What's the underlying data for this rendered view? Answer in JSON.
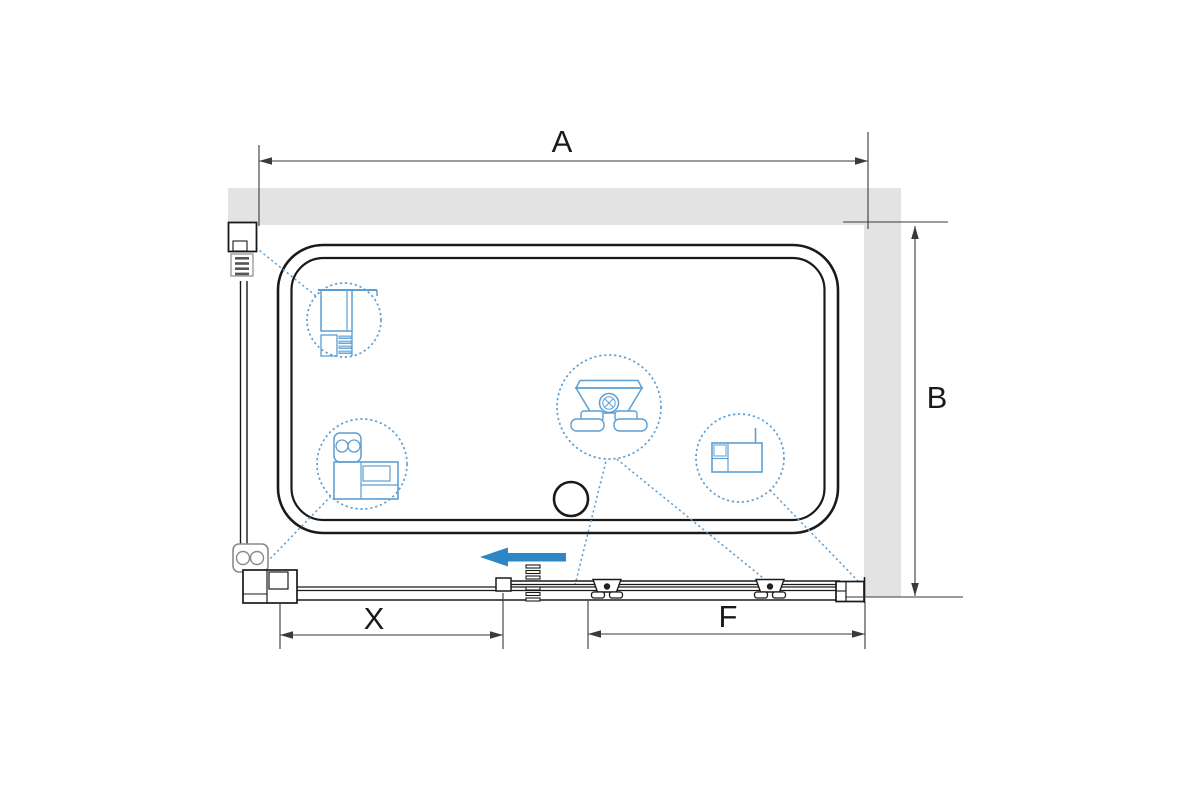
{
  "diagram": {
    "subject": "shower-enclosure-top-view-scheme",
    "dimension_labels": {
      "a": "A",
      "b": "B",
      "x": "X",
      "f": "F"
    },
    "colors": {
      "background": "#ffffff",
      "wall-fill": "#e3e3e3",
      "line": "#1a1a1a",
      "dim-line": "#3a3a3a",
      "hardware-gray": "#8a8a8a",
      "accent-blue": "#2e86c4",
      "detail-blue": "#5b9fd4",
      "detail-blue-light": "#aecfe8"
    },
    "callouts": {
      "top_left": "wall-profile-cross-section",
      "bottom_left": "corner-profile-cross-section",
      "center": "roller-carriage-detail",
      "right": "wall-mount-profile-cross-section"
    },
    "arrow": "door-slide-direction-left"
  }
}
